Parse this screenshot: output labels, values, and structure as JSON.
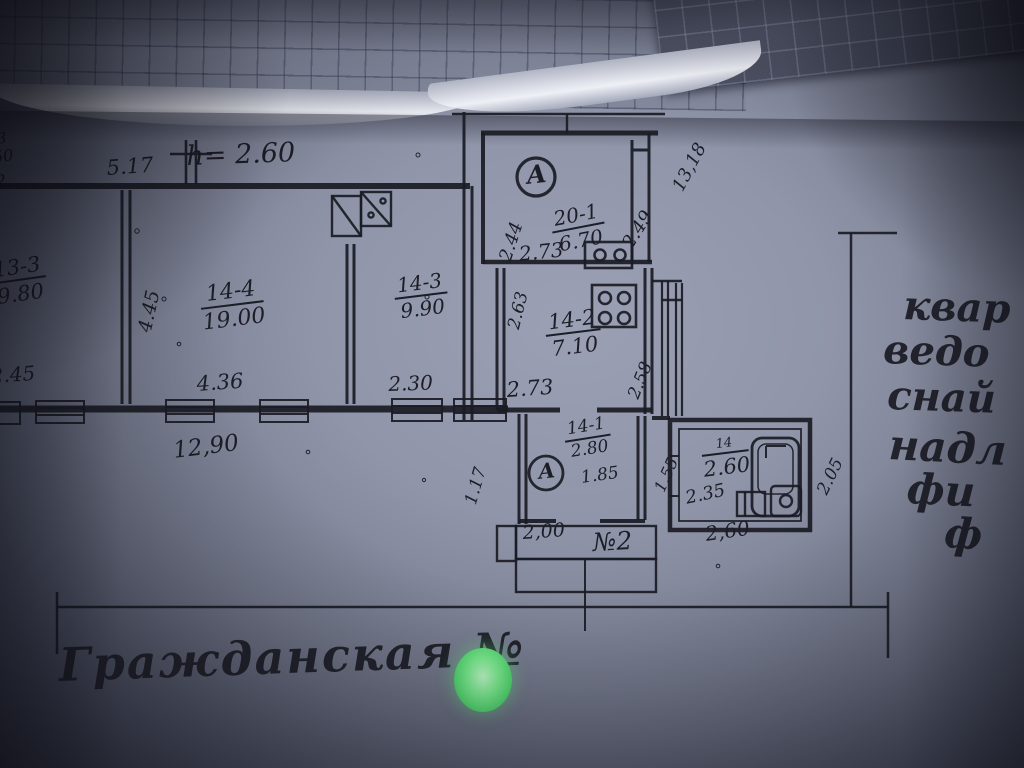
{
  "photo": {
    "street_caption": "Гражданская №",
    "margin_note_lines": [
      "квар",
      "ведо",
      "снай",
      "надл",
      "фи",
      "ф"
    ],
    "green_dot_color": "#74f18c",
    "ink_color": "#1a1b24"
  },
  "plan": {
    "height_note": "h= 2.60",
    "axis_marker": "А",
    "entrance_label": "№2",
    "rooms": {
      "r13_3": {
        "num": "13-3",
        "area": "9.80"
      },
      "r14_4": {
        "num": "14-4",
        "area": "19.00"
      },
      "r14_3": {
        "num": "14-3",
        "area": "9.90"
      },
      "r20_1": {
        "num": "20-1",
        "area": "6.70"
      },
      "r14_2": {
        "num": "14-2",
        "area": "7.10"
      },
      "r14_1": {
        "num": "14-1",
        "area": "2.80",
        "inner": "1.85"
      },
      "bath": {
        "num": "14",
        "area": "2.60"
      }
    },
    "dims": {
      "d5_17": "5.17",
      "d4_45": "4.45",
      "d2_45": "2.45",
      "d4_36": "4.36",
      "d2_30": "2.30",
      "d12_90": "12,90",
      "d2_44": "2.44",
      "d2_73a": "2.73",
      "d2_49": "2.49",
      "d13_18": "13,18",
      "d2_63": "2.63",
      "d2_73b": "2.73",
      "d2_58": "2.58",
      "d1_17": "1.17",
      "d1_55": "1.55",
      "d2_35": "2.35",
      "d2_05": "2.05",
      "d2_00": "2,00",
      "d2_60": "2,60"
    },
    "edge_fragments": [
      "3",
      "50",
      "2"
    ]
  }
}
